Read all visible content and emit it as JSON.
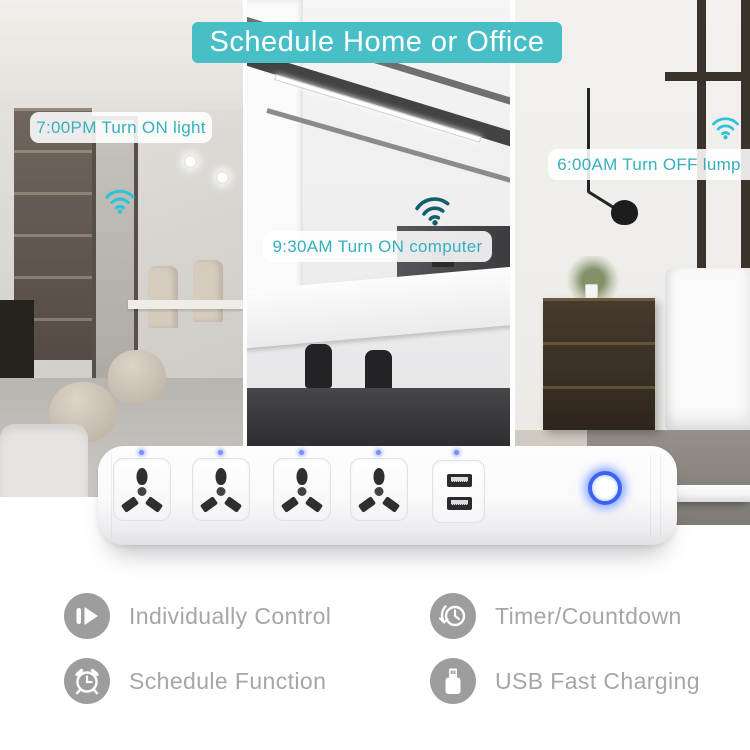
{
  "banner": {
    "label": "Schedule Home or Office"
  },
  "scenes": [
    {
      "name": "living-room",
      "caption": "7:00PM Turn ON light"
    },
    {
      "name": "office",
      "caption": "9:30AM Turn ON computer"
    },
    {
      "name": "bedroom",
      "caption": "6:00AM Turn OFF lump"
    }
  ],
  "device": {
    "sockets": 4,
    "usb_ports": 2,
    "status_leds": 5,
    "power_button_state": "on"
  },
  "features": [
    {
      "icon": "individually-control-icon",
      "label": "Individually Control"
    },
    {
      "icon": "timer-countdown-icon",
      "label": "Timer/Countdown"
    },
    {
      "icon": "schedule-function-icon",
      "label": "Schedule Function"
    },
    {
      "icon": "usb-fast-charging-icon",
      "label": "USB Fast Charging"
    }
  ],
  "colors": {
    "accent_teal": "#48bfc7",
    "caption_teal": "#35b1bf",
    "wifi_cyan": "#2bc4d9",
    "wifi_dark": "#11616d",
    "button_blue": "#3b63f0",
    "led_blue": "#7d90f2",
    "feature_gray": "#9d9d9d",
    "feature_text": "#a6a6a6"
  }
}
